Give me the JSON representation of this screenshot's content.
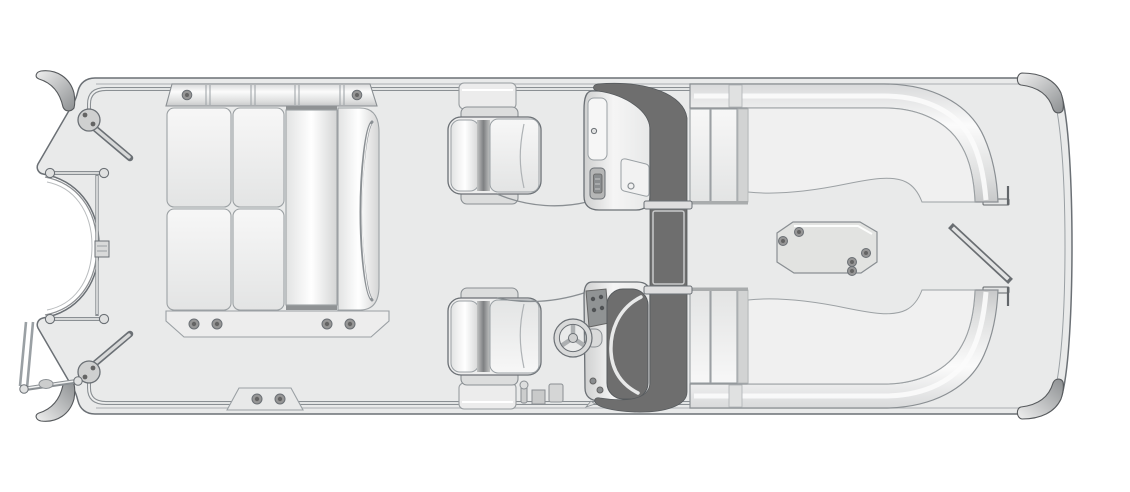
{
  "diagram": {
    "kind": "pontoon-boat-deck-floorplan",
    "style": "grayscale top-down line illustration, no text labels",
    "orientation": {
      "bow": "right",
      "stern": "left"
    }
  },
  "colors": {
    "page": "#ffffff",
    "deck": "#e9eaea",
    "outline": "#6b7075",
    "soft": "#9aa0a4",
    "fence": "#8a8f93",
    "fence_core": "#eff0f0",
    "cushion": "#f2f2f2",
    "shade": "#d8d8d8",
    "glass": "#6e6e6e",
    "glass_edge": "#565a5d",
    "hardware": "#969696",
    "hardware_dark": "#646464",
    "table": "#e2e3e1"
  },
  "parts": {
    "hull": [
      "deck-outline",
      "rub-rail",
      "right-bow-panel-line",
      "motor-well-cutout-left",
      "cutout-rim-rails"
    ],
    "corner_hardware": [
      "corner-bumper-top-left",
      "corner-bumper-bottom-left",
      "corner-cap-top-right",
      "corner-cap-bottom-right"
    ],
    "stern_hardware": [
      "stern-rail-frame",
      "rail-bar-top",
      "rail-bar-bottom",
      "gate-hinge-top",
      "gate-hinge-bottom",
      "gate-rail-top",
      "gate-rail-bottom",
      "boarding-ladder",
      "motor-mount-bracket"
    ],
    "aft_lounge": {
      "backrest_strip_fasteners": 2,
      "seat_cushions": 4,
      "chaise_cushions": 2,
      "grab_handle": 1,
      "base_trim_fasteners": 4,
      "tow_plate_fasteners": 2
    },
    "helm_area": {
      "captain_chairs": 2,
      "seat_cables": 2,
      "fence_gate_blocks": 2,
      "gate_latch_pieces": 3
    },
    "passenger_console": [
      "storage-door",
      "door-knob",
      "latch-vent",
      "access-panel",
      "panel-latch-ring"
    ],
    "helm_console": {
      "gauge_panel_dots": 4,
      "steering_wheel_spokes": 3,
      "switch_dots": 2,
      "windshield_glass": "dark with light crescent"
    },
    "walk_through_windshield": [
      "dark-arch-band",
      "center-door-frame-top",
      "center-door-frame-bottom",
      "center-door-panel"
    ],
    "bow_area": {
      "port_bow_lounge": "L-shaped backrest curving to gate",
      "starboard_bow_lounge": "mirror of port lounge",
      "pedestal_table_fasteners": 5,
      "bow_gate": "drawn open, diagonal bar",
      "gate_end_brackets": 2
    }
  },
  "element_counts": {
    "captain_chairs": 2,
    "consoles": 2,
    "lounges": 3,
    "tables": 1,
    "fastener_dots_total": 17
  }
}
